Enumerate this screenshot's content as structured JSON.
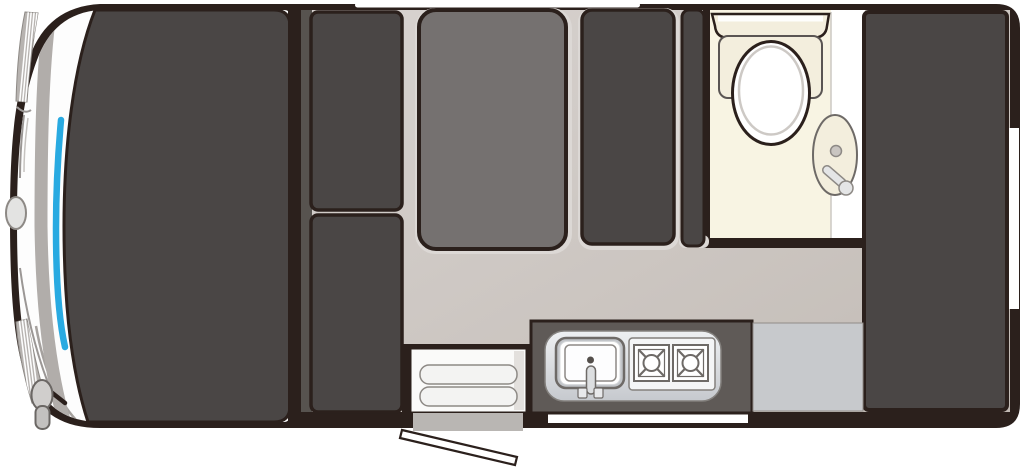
{
  "page": {
    "background": "#ffffff",
    "description_name": "campervan-floorplan-top-view"
  },
  "colors": {
    "outline": "#2b201c",
    "body_dark": "#4a4645",
    "cushion_gray": "#757170",
    "wall_strip": "#57534f",
    "counter_frame": "#5f5a57",
    "floor_light": "#d8d3d0",
    "floor_dark": "#c2bbb5",
    "edge_highlight": "#dcd8d5",
    "bathroom_cream": "#f8f4e3",
    "fixture_cream": "#f3eedd",
    "white": "#ffffff",
    "windshield_blue": "#29aae1",
    "steel_light": "#eef0f2",
    "steel_mid": "#c6c9ce",
    "metal_outline": "#6e6a67",
    "metal_mid": "#8d8985",
    "step_gray": "#b9b6b3",
    "hatch_gray": "#b7b3b0",
    "band_gray": "#b1adaa",
    "crease_gray": "#9b9795",
    "seat_ring_gray": "#cdc9c5",
    "mirror_gray": "#d0cecc",
    "glass_white": "#fdfdfd",
    "fridge_gray": "#c7c9cc"
  },
  "floorplan": {
    "vehicle": "campervan-top-view",
    "zones": [
      {
        "name": "driver-cab"
      },
      {
        "name": "lounge"
      },
      {
        "name": "kitchen"
      },
      {
        "name": "bathroom"
      },
      {
        "name": "rear-storage"
      }
    ],
    "fixtures": [
      {
        "name": "windshield"
      },
      {
        "name": "side-mirror"
      },
      {
        "name": "front-badge"
      },
      {
        "name": "side-seat-upper"
      },
      {
        "name": "side-seat-lower"
      },
      {
        "name": "bed-cushion"
      },
      {
        "name": "dinette-seat"
      },
      {
        "name": "partition-cabinet"
      },
      {
        "name": "toilet"
      },
      {
        "name": "washbasin"
      },
      {
        "name": "shower-wall"
      },
      {
        "name": "rear-bed"
      },
      {
        "name": "kitchen-sink"
      },
      {
        "name": "stove-two-burner"
      },
      {
        "name": "fridge-cabinet"
      },
      {
        "name": "entry-step"
      },
      {
        "name": "exterior-step"
      },
      {
        "name": "entry-door-open"
      },
      {
        "name": "top-window"
      },
      {
        "name": "door-window"
      },
      {
        "name": "rear-side-window"
      }
    ]
  }
}
